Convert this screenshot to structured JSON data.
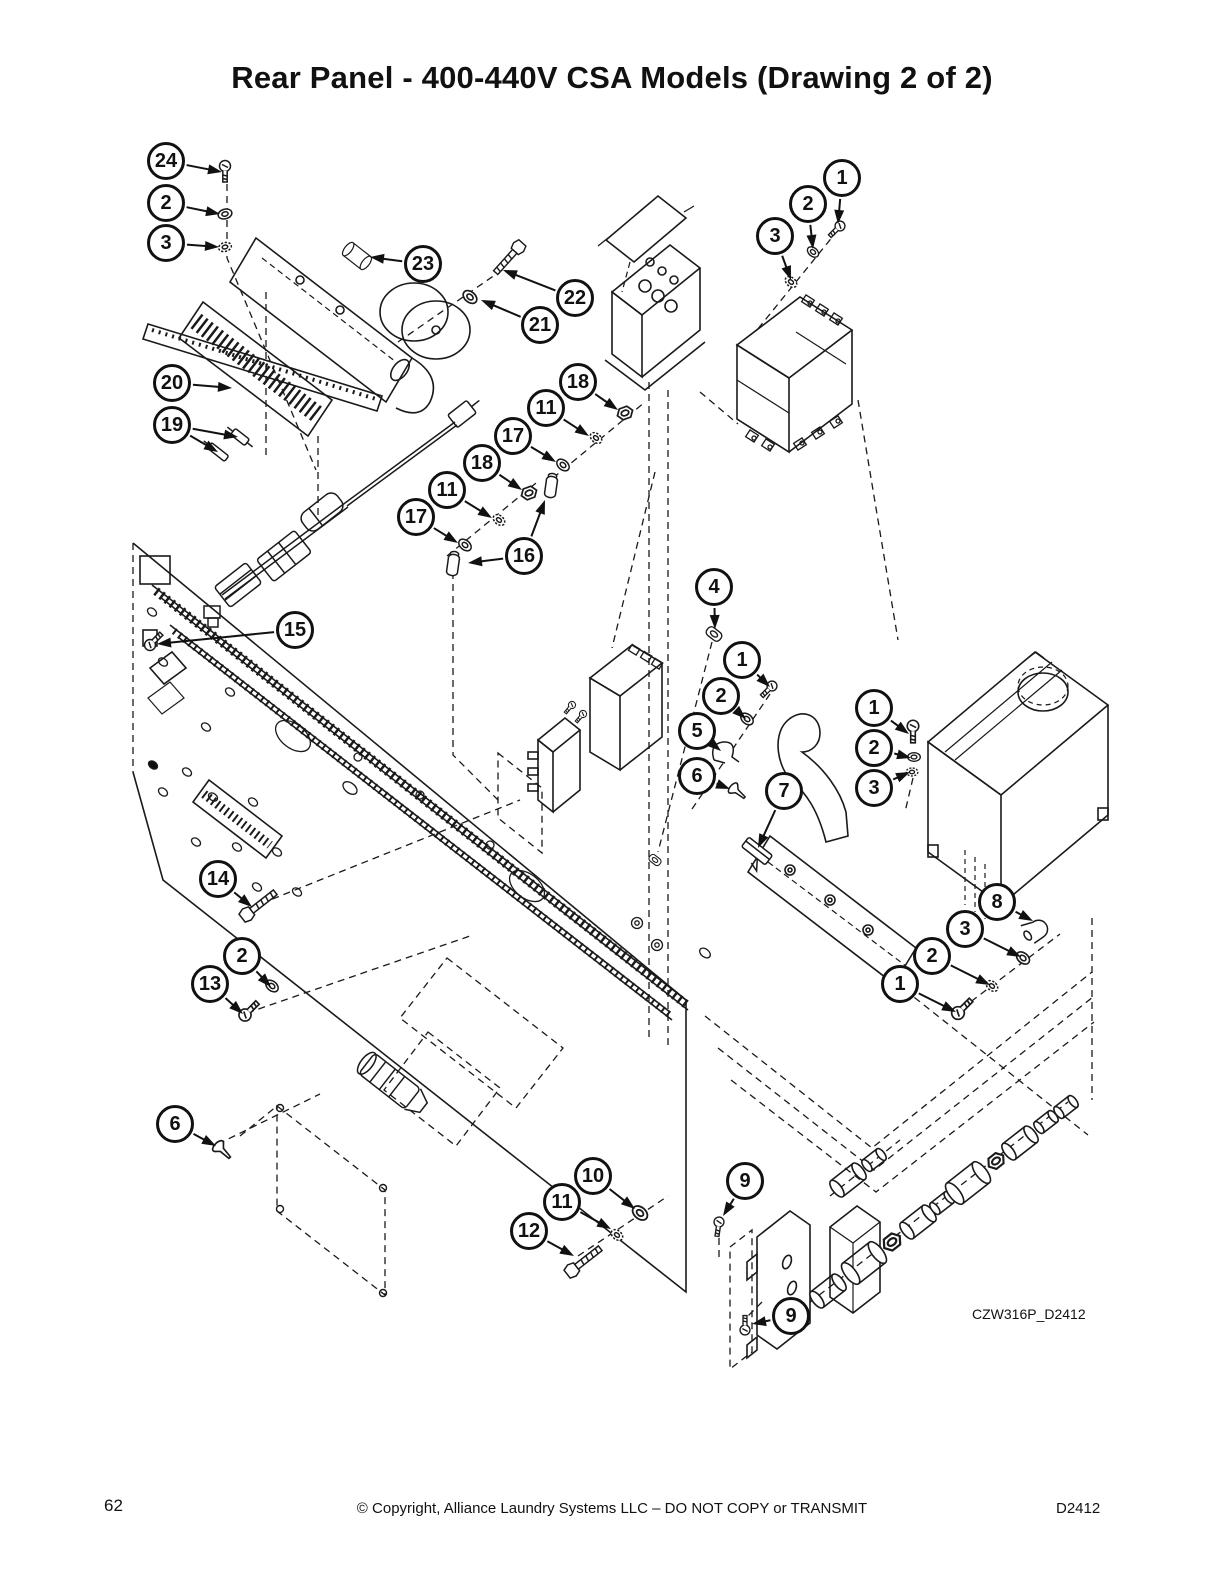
{
  "title": "Rear Panel - 400-440V CSA Models (Drawing 2 of 2)",
  "drawing_code": "CZW316P_D2412",
  "footer": {
    "page_number": "62",
    "copyright": "© Copyright, Alliance Laundry Systems LLC – DO NOT COPY or TRANSMIT",
    "doc_code": "D2412"
  },
  "colors": {
    "ink": "#111111",
    "paper": "#ffffff"
  },
  "callouts": [
    {
      "label": "24",
      "x": 166,
      "y": 161,
      "targets": [
        [
          222,
          172
        ]
      ]
    },
    {
      "label": "2",
      "x": 166,
      "y": 203,
      "targets": [
        [
          220,
          214
        ]
      ]
    },
    {
      "label": "3",
      "x": 166,
      "y": 243,
      "targets": [
        [
          219,
          247
        ]
      ]
    },
    {
      "label": "23",
      "x": 423,
      "y": 264,
      "targets": [
        [
          370,
          257
        ]
      ]
    },
    {
      "label": "22",
      "x": 575,
      "y": 298,
      "targets": [
        [
          503,
          270
        ]
      ]
    },
    {
      "label": "21",
      "x": 540,
      "y": 325,
      "targets": [
        [
          481,
          300
        ]
      ]
    },
    {
      "label": "20",
      "x": 172,
      "y": 383,
      "targets": [
        [
          232,
          388
        ]
      ]
    },
    {
      "label": "19",
      "x": 172,
      "y": 425,
      "targets": [
        [
          238,
          437
        ],
        [
          218,
          452
        ]
      ]
    },
    {
      "label": "18",
      "x": 578,
      "y": 382,
      "targets": [
        [
          618,
          410
        ]
      ]
    },
    {
      "label": "11",
      "x": 546,
      "y": 408,
      "targets": [
        [
          589,
          436
        ]
      ]
    },
    {
      "label": "17",
      "x": 513,
      "y": 436,
      "targets": [
        [
          556,
          462
        ]
      ]
    },
    {
      "label": "18",
      "x": 482,
      "y": 463,
      "targets": [
        [
          522,
          490
        ]
      ]
    },
    {
      "label": "11",
      "x": 447,
      "y": 490,
      "targets": [
        [
          492,
          518
        ]
      ]
    },
    {
      "label": "17",
      "x": 416,
      "y": 517,
      "targets": [
        [
          458,
          543
        ]
      ]
    },
    {
      "label": "16",
      "x": 524,
      "y": 556,
      "targets": [
        [
          468,
          563
        ],
        [
          545,
          500
        ]
      ]
    },
    {
      "label": "1",
      "x": 842,
      "y": 178,
      "targets": [
        [
          838,
          224
        ]
      ]
    },
    {
      "label": "2",
      "x": 808,
      "y": 204,
      "targets": [
        [
          813,
          249
        ]
      ]
    },
    {
      "label": "3",
      "x": 775,
      "y": 236,
      "targets": [
        [
          791,
          280
        ]
      ]
    },
    {
      "label": "4",
      "x": 714,
      "y": 587,
      "targets": [
        [
          715,
          629
        ]
      ]
    },
    {
      "label": "1",
      "x": 742,
      "y": 660,
      "targets": [
        [
          770,
          687
        ]
      ]
    },
    {
      "label": "2",
      "x": 721,
      "y": 696,
      "targets": [
        [
          746,
          719
        ]
      ]
    },
    {
      "label": "5",
      "x": 697,
      "y": 731,
      "targets": [
        [
          721,
          751
        ]
      ]
    },
    {
      "label": "6",
      "x": 697,
      "y": 776,
      "targets": [
        [
          730,
          789
        ]
      ]
    },
    {
      "label": "7",
      "x": 784,
      "y": 791,
      "targets": [
        [
          758,
          848
        ]
      ]
    },
    {
      "label": "1",
      "x": 874,
      "y": 708,
      "targets": [
        [
          909,
          734
        ]
      ]
    },
    {
      "label": "2",
      "x": 874,
      "y": 748,
      "targets": [
        [
          911,
          758
        ]
      ]
    },
    {
      "label": "3",
      "x": 874,
      "y": 788,
      "targets": [
        [
          910,
          772
        ]
      ]
    },
    {
      "label": "15",
      "x": 295,
      "y": 630,
      "targets": [
        [
          157,
          644
        ]
      ]
    },
    {
      "label": "14",
      "x": 218,
      "y": 879,
      "targets": [
        [
          252,
          907
        ]
      ]
    },
    {
      "label": "2",
      "x": 242,
      "y": 956,
      "targets": [
        [
          271,
          987
        ]
      ]
    },
    {
      "label": "13",
      "x": 210,
      "y": 984,
      "targets": [
        [
          243,
          1014
        ]
      ]
    },
    {
      "label": "6",
      "x": 175,
      "y": 1124,
      "targets": [
        [
          216,
          1146
        ]
      ]
    },
    {
      "label": "10",
      "x": 593,
      "y": 1176,
      "targets": [
        [
          635,
          1209
        ]
      ]
    },
    {
      "label": "11",
      "x": 562,
      "y": 1202,
      "targets": [
        [
          611,
          1229
        ]
      ]
    },
    {
      "label": "12",
      "x": 529,
      "y": 1231,
      "targets": [
        [
          574,
          1256
        ]
      ]
    },
    {
      "label": "9",
      "x": 745,
      "y": 1181,
      "targets": [
        [
          723,
          1216
        ]
      ]
    },
    {
      "label": "9",
      "x": 791,
      "y": 1316,
      "targets": [
        [
          752,
          1324
        ]
      ]
    },
    {
      "label": "8",
      "x": 997,
      "y": 902,
      "targets": [
        [
          1033,
          921
        ]
      ]
    },
    {
      "label": "3",
      "x": 965,
      "y": 929,
      "targets": [
        [
          1021,
          957
        ]
      ]
    },
    {
      "label": "2",
      "x": 932,
      "y": 956,
      "targets": [
        [
          990,
          985
        ]
      ]
    },
    {
      "label": "1",
      "x": 900,
      "y": 984,
      "targets": [
        [
          956,
          1012
        ]
      ]
    }
  ]
}
